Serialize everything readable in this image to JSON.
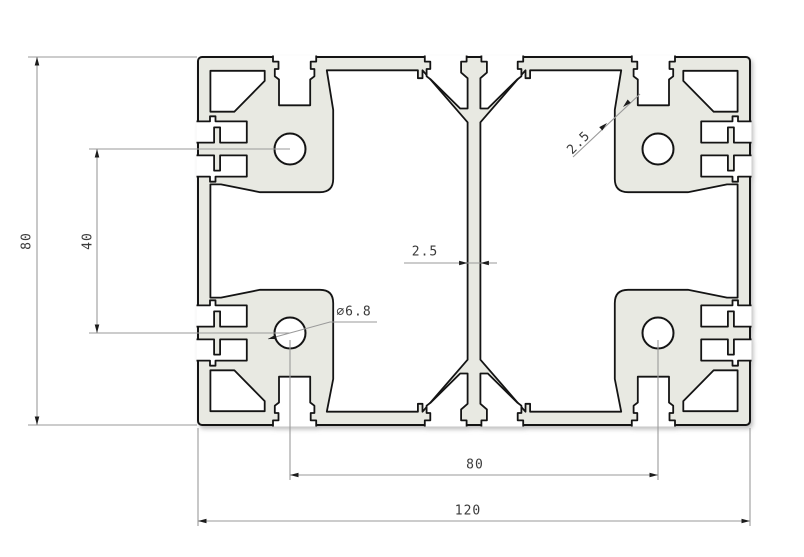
{
  "drawing": {
    "type": "technical-cross-section",
    "part": "aluminium t-slot extrusion profile 120x80",
    "dimensions": {
      "overall_height": "80",
      "hole_pitch_vertical": "40",
      "web_thickness": "2.5",
      "wall_thickness": "2.5",
      "hole_diameter": "∅6.8",
      "hole_pitch_horizontal": "80",
      "overall_width": "120"
    },
    "colors": {
      "material_fill": "#e8e9e2",
      "outline": "#141414",
      "dimension_lines": "#9a9a9a",
      "dimension_text": "#3a3a3a",
      "background": "#ffffff"
    }
  }
}
